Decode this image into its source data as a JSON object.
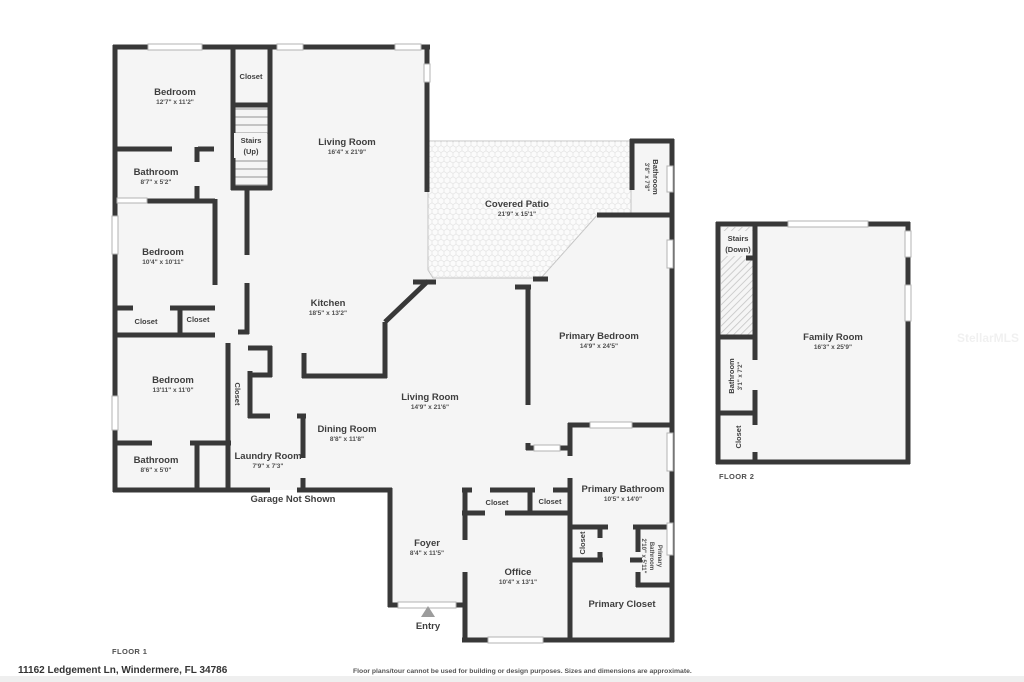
{
  "watermark": "StellarMLS",
  "footer": {
    "address": "11162 Ledgement Ln, Windermere, FL 34786",
    "disclaimer": "Floor plans/tour cannot be used for building or design purposes. Sizes and dimensions are approximate."
  },
  "floor1": {
    "label": "FLOOR 1",
    "bedroom1": {
      "name": "Bedroom",
      "dims": "12'7\" x 11'2\""
    },
    "closet_top": {
      "name": "Closet"
    },
    "stairs": {
      "name": "Stairs",
      "direction": "(Up)"
    },
    "living_room_upper": {
      "name": "Living Room",
      "dims": "16'4\" x 21'9\""
    },
    "covered_patio": {
      "name": "Covered Patio",
      "dims": "21'9\" x 15'1\""
    },
    "patio_bathroom": {
      "name": "Bathroom",
      "dims": "3'8\" x 7'8\""
    },
    "bathroom1": {
      "name": "Bathroom",
      "dims": "8'7\" x 5'2\""
    },
    "bedroom2": {
      "name": "Bedroom",
      "dims": "10'4\" x 10'11\""
    },
    "closet_a": {
      "name": "Closet"
    },
    "closet_b": {
      "name": "Closet"
    },
    "kitchen": {
      "name": "Kitchen",
      "dims": "18'5\" x 13'2\""
    },
    "bedroom3": {
      "name": "Bedroom",
      "dims": "13'11\" x 11'0\""
    },
    "closet_hall": {
      "name": "Closet"
    },
    "living_room_main": {
      "name": "Living Room",
      "dims": "14'9\" x 21'6\""
    },
    "primary_bedroom": {
      "name": "Primary Bedroom",
      "dims": "14'9\" x 24'5\""
    },
    "dining_room": {
      "name": "Dining Room",
      "dims": "8'8\" x 11'8\""
    },
    "laundry_room": {
      "name": "Laundry Room",
      "dims": "7'9\" x 7'3\""
    },
    "bathroom2": {
      "name": "Bathroom",
      "dims": "8'6\" x 5'0\""
    },
    "garage_note": "Garage Not Shown",
    "foyer": {
      "name": "Foyer",
      "dims": "8'4\" x 11'5\""
    },
    "closet_c": {
      "name": "Closet"
    },
    "closet_d": {
      "name": "Closet"
    },
    "primary_bathroom": {
      "name": "Primary Bathroom",
      "dims": "10'5\" x 14'0\""
    },
    "closet_e": {
      "name": "Closet"
    },
    "primary_bathroom_small": {
      "line1": "Primary",
      "line2": "Bathroom",
      "dims": "2'10\" x 5'11\""
    },
    "office": {
      "name": "Office",
      "dims": "10'4\" x 13'1\""
    },
    "primary_closet": {
      "name": "Primary Closet"
    },
    "entry_label": "Entry"
  },
  "floor2": {
    "label": "FLOOR 2",
    "stairs": {
      "name": "Stairs",
      "direction": "(Down)"
    },
    "family_room": {
      "name": "Family Room",
      "dims": "16'3\" x 25'9\""
    },
    "bathroom": {
      "name": "Bathroom",
      "dims": "3'1\" x 7'2\""
    },
    "closet": {
      "name": "Closet"
    }
  }
}
